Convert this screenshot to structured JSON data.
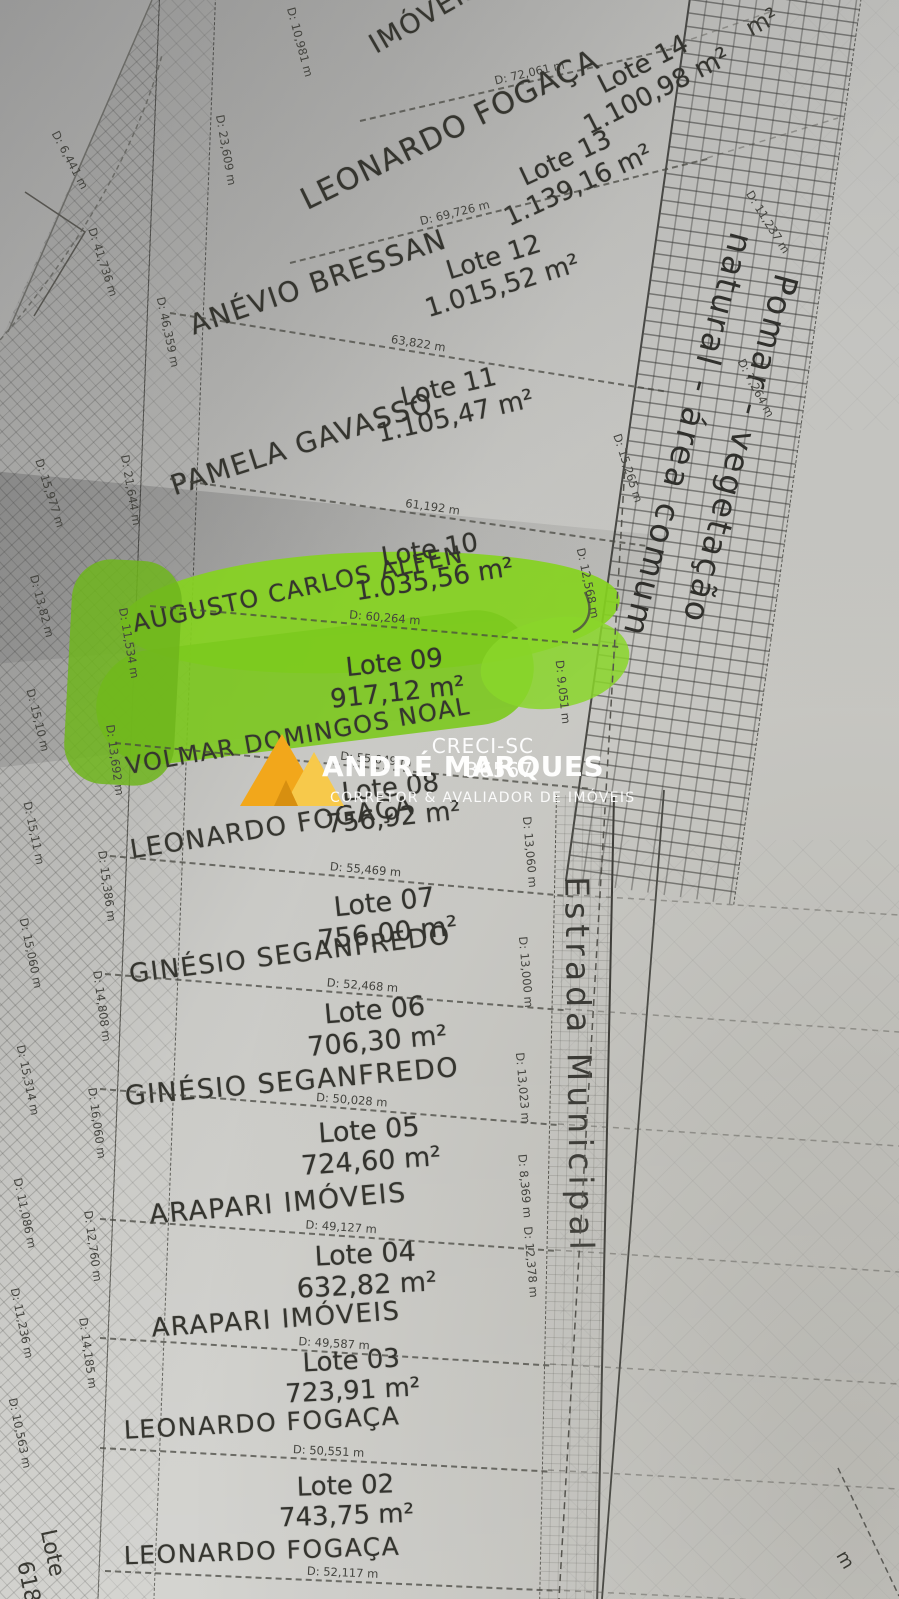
{
  "palette": {
    "paper": "#cfcfcb",
    "ink": "#35352f",
    "highlight_green": "#86d320",
    "logo_gold": "#f2a71b",
    "logo_gold_light": "#f7c94b",
    "watermark_text": "#ffffff"
  },
  "watermark": {
    "creci": "CRECI-SC 36567",
    "name": "ANDRÉ MARQUES",
    "tagline": "CORRETOR & AVALIADOR DE IMÓVEIS"
  },
  "roads": {
    "estrada_label": "Estrada Municipal",
    "pomar_line1": "Pomar - vegetação",
    "pomar_line2": "natural - área comum"
  },
  "lots": [
    {
      "label": "Lote 14",
      "area": "1.100,98 m²",
      "owner": "IMÓVEIS",
      "dim": "D: 72,061 m"
    },
    {
      "label": "Lote 13",
      "area": "1.139,16 m²",
      "owner": "LEONARDO FOGAÇA",
      "dim": "D: 69,726 m"
    },
    {
      "label": "Lote 12",
      "area": "1.015,52 m²",
      "owner": "ANÉVIO BRESSAN",
      "dim": "63,822 m"
    },
    {
      "label": "Lote 11",
      "area": "1.105,47 m²",
      "owner": "PAMELA GAVASSO",
      "dim": "61,192 m"
    },
    {
      "label": "Lote 10",
      "area": "1.035,56 m²",
      "owner": "AUGUSTO CARLOS ALFEN",
      "dim": "D: 60,264 m"
    },
    {
      "label": "Lote 09",
      "area": "917,12 m²",
      "owner": "VOLMAR DOMINGOS NOAL",
      "dim": "D: 55,049 m",
      "highlighted": true
    },
    {
      "label": "Lote 08",
      "area": "756,92 m²",
      "owner": "LEONARDO FOGAÇA",
      "dim": "D: 55,469 m"
    },
    {
      "label": "Lote 07",
      "area": "756,00 m²",
      "owner": "GINÉSIO SEGANFREDO",
      "dim": "D: 52,468 m"
    },
    {
      "label": "Lote 06",
      "area": "706,30 m²",
      "owner": "GINÉSIO SEGANFREDO",
      "dim": "D: 50,028 m"
    },
    {
      "label": "Lote 05",
      "area": "724,60 m²",
      "owner": "ARAPARI IMÓVEIS",
      "dim": "D: 49,127 m"
    },
    {
      "label": "Lote 04",
      "area": "632,82 m²",
      "owner": "ARAPARI IMÓVEIS",
      "dim": "D: 49,587 m"
    },
    {
      "label": "Lote 03",
      "area": "723,91 m²",
      "owner": "LEONARDO FOGAÇA",
      "dim": "D: 50,551 m"
    },
    {
      "label": "Lote 02",
      "area": "743,75 m²",
      "owner": "LEONARDO FOGAÇA",
      "dim": "D: 52,117 m"
    }
  ],
  "left_dimensions": [
    "D: 10,981 m",
    "D: 23,609 m",
    "D: 6,441 m",
    "D: 41,736 m",
    "D: 46,359 m",
    "D: 21,644 m",
    "D: 15,977 m",
    "D: 13,82 m",
    "D: 11,534 m",
    "D: 15,10 m",
    "D: 13,692 m",
    "D: 15,11 m",
    "D: 15,386 m",
    "D: 15,060 m",
    "D: 14,808 m",
    "D: 15,314 m",
    "D: 16,060 m",
    "D: 11,086 m",
    "D: 12,760 m",
    "D: 11,236 m",
    "D: 14,185 m",
    "D: 10,563 m"
  ],
  "right_dimensions": [
    "D: 13,060 m",
    "D: 13,000 m",
    "D: 13,023 m",
    "D: 8,369 m",
    "D: 12,378 m"
  ],
  "pomar_edge_dimensions": [
    "D: 11,237 m",
    "D: 7,264 m",
    "D: 15,265 m",
    "D: 12,568 m",
    "D: 9,051 m"
  ],
  "partials": {
    "top_right_area": "m²",
    "bottom_left_lote": "Lote",
    "bottom_left_num": "618",
    "bottom_right": "m"
  }
}
